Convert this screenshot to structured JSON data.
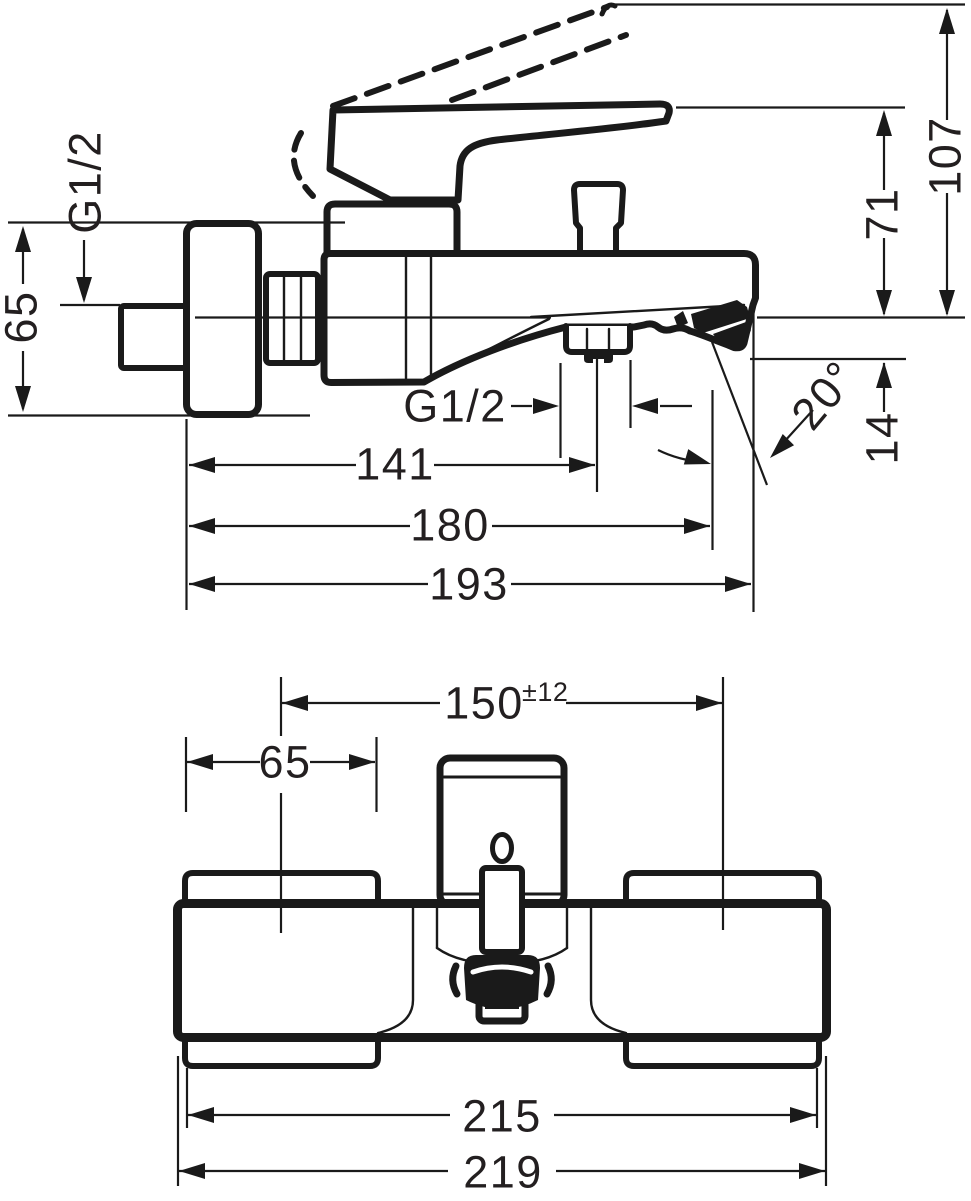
{
  "page": {
    "background": "#ffffff",
    "line_color": "#1a1a1a",
    "text_color": "#231f20"
  },
  "side_view": {
    "labels": {
      "wall_thread": "G1/2",
      "escutcheon_height": "65",
      "height_handle_open": "107",
      "height_handle_closed": "71",
      "spout_outlet_drop": "14",
      "spout_angle": "20°",
      "outlet_thread": "G1/2",
      "wall_to_outlet": "141",
      "wall_to_spout_edge": "180",
      "wall_to_tip": "193"
    }
  },
  "front_view": {
    "labels": {
      "connection_centers": "150",
      "connection_tolerance": "±12",
      "escutcheon_width": "65",
      "escutcheon_span": "215",
      "overall_width": "219"
    }
  }
}
